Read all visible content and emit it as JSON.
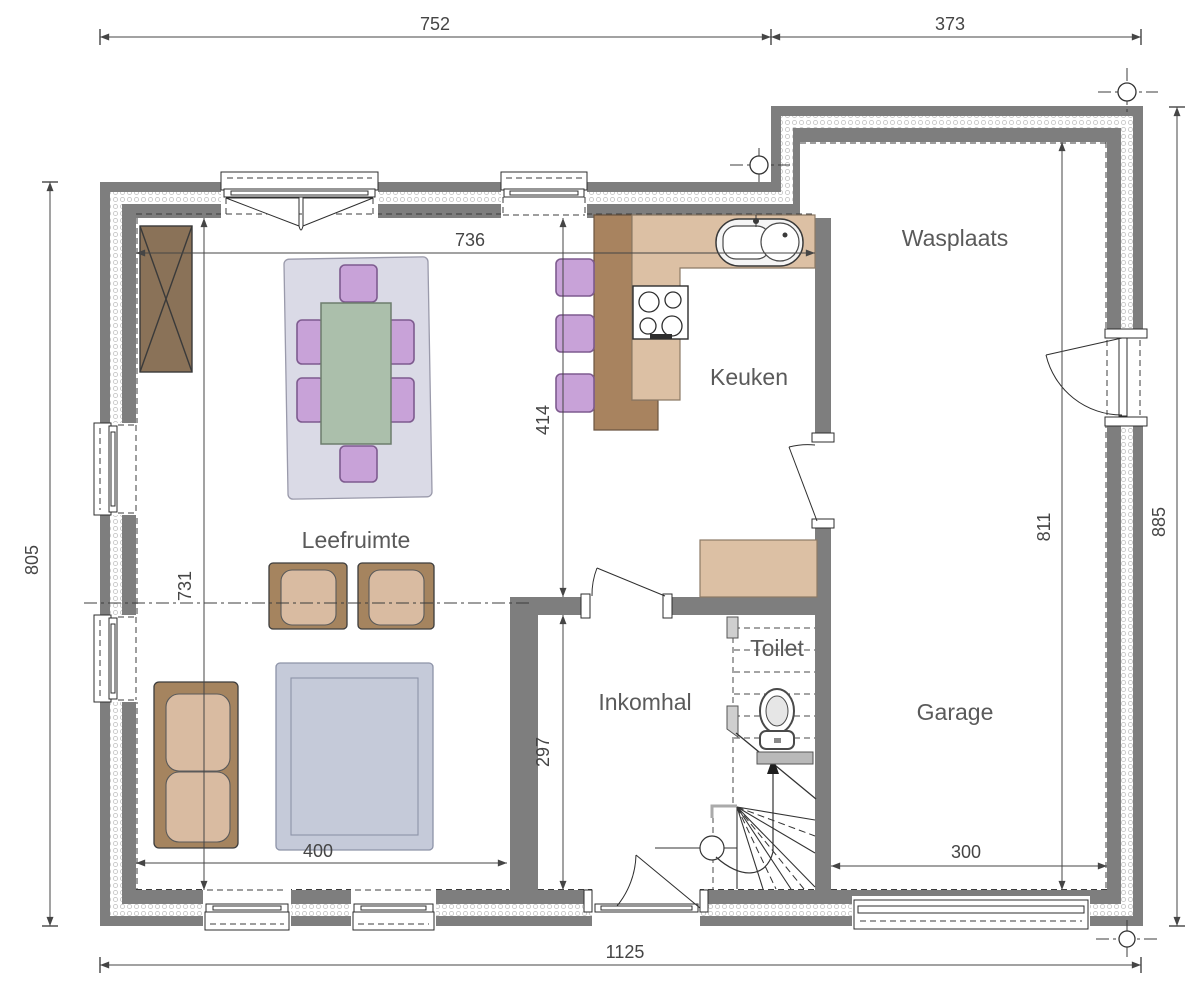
{
  "plan": {
    "rooms": {
      "leefruimte": "Leefruimte",
      "keuken": "Keuken",
      "wasplaats": "Wasplaats",
      "inkomhal": "Inkomhal",
      "toilet": "Toilet",
      "garage": "Garage"
    },
    "dims": {
      "top_left": "752",
      "top_right": "373",
      "bottom_total": "1125",
      "left_total": "805",
      "right_total": "885",
      "garage_interior_height": "811",
      "interior_width_top": "736",
      "kitchen_depth": "414",
      "living_height": "731",
      "hall_height": "297",
      "living_width": "400",
      "garage_width": "300"
    },
    "colors": {
      "wall": "#7e7e7e",
      "dimension": "#454545",
      "label": "#5a5a5a",
      "counter": "#dcc0a4",
      "counter_dark": "#a8835f",
      "wood": "#a5845f",
      "cushion": "#d9bba1",
      "cabinet": "#8a7258",
      "chair": "#c8a2d8",
      "table": "#abbfab",
      "rug_dining": "#dadae6",
      "rug_living": "#c5cad9"
    }
  }
}
